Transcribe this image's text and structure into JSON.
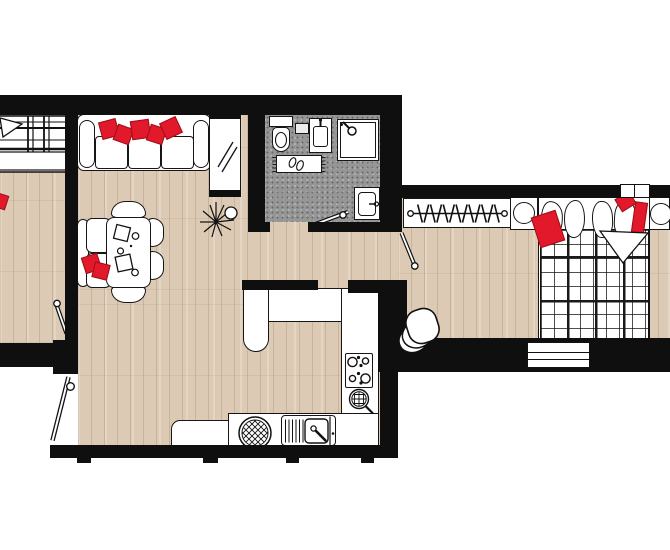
{
  "document": {
    "title": "apartment-floor-plan",
    "type": "architectural-floor-plan",
    "visible_text": "none"
  },
  "palette": {
    "bg": "#ffffff",
    "wall": "#0f0f0f",
    "outline": "#161616",
    "fill": "#ffffff",
    "wood": "#dccab4",
    "wood-grain": "#7a5c3e",
    "tile": "#969696",
    "accent-red": "#e2182b",
    "accent-red-dark": "#9d1018"
  },
  "rooms": [
    {
      "id": "living-room",
      "floor": "wood",
      "furniture": [
        "sofa",
        "sofa-red-pillows",
        "mirror-cabinet",
        "dining-table",
        "dining-chairs",
        "loveseat",
        "loveseat-red-pillows",
        "plant"
      ]
    },
    {
      "id": "bathroom",
      "floor": "gray-tile",
      "furniture": [
        "toilet",
        "wall-shelf",
        "washbasin",
        "shower",
        "bath-mat",
        "slippers",
        "washing-machine"
      ]
    },
    {
      "id": "kitchen",
      "floor": "wood",
      "furniture": [
        "counter-top",
        "counter-peninsula",
        "counter-right",
        "counter-bottom",
        "stove",
        "trivet",
        "basket",
        "sink-with-drainboard"
      ]
    },
    {
      "id": "bedroom",
      "floor": "wood",
      "furniture": [
        "double-bed",
        "plaid-blanket",
        "bed-pillows",
        "bed-red-pillows",
        "clothes-rack",
        "bedside-table-left",
        "bedside-table-right",
        "lamp-left",
        "lamp-right",
        "corner-chair"
      ]
    },
    {
      "id": "side-room",
      "floor": "wood",
      "furniture": [
        "bed-partial",
        "red-cushion",
        "blanket-corner"
      ]
    },
    {
      "id": "hallway",
      "floor": "wood",
      "furniture": []
    }
  ],
  "doors": [
    "side-room-door",
    "entrance-door",
    "bathroom-door",
    "bedroom-door"
  ],
  "windows": [
    "bedroom-window-north",
    "bedroom-window-south"
  ],
  "counts": {
    "sofa_red_pillows": 5,
    "dining_chairs": 4,
    "stove_burners": 4,
    "hangers": 13,
    "bed_pillows": 4,
    "door_swings": 4,
    "wall_ticks": 4
  }
}
